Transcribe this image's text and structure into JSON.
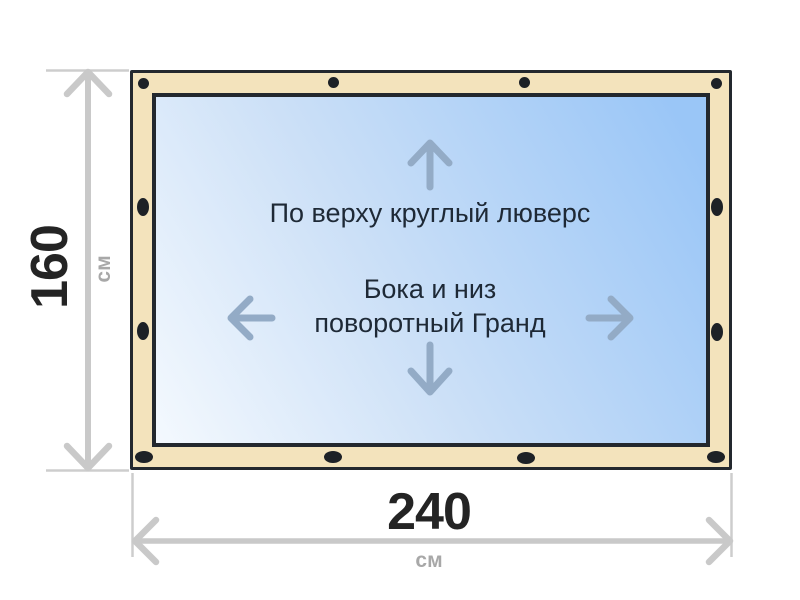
{
  "diagram": {
    "top_note": "По верху круглый люверс",
    "center_note_line1": "Бока и низ",
    "center_note_line2": "поворотный Гранд"
  },
  "dimensions": {
    "height": {
      "value": "160",
      "unit": "см"
    },
    "width": {
      "value": "240",
      "unit": "см"
    }
  },
  "icons": {
    "inner_arrows": [
      "up-arrow",
      "left-arrow",
      "right-arrow",
      "down-arrow"
    ],
    "grommets": "black ellipses along banner frame edges"
  },
  "colors": {
    "background": "#ffffff",
    "frame_fill": "#f3e3bc",
    "frame_border": "#23282e",
    "canvas_blue_light": "#f4f9fe",
    "canvas_blue_dark": "#9ac6f7",
    "grommet": "#1d2126",
    "dimension_line": "#c9c9c9",
    "extension_line": "#cdcdcd",
    "unit_text": "#a8a8a8",
    "value_text": "#242424",
    "note_text": "#1e2936",
    "inner_arrow": "#93abc6"
  }
}
